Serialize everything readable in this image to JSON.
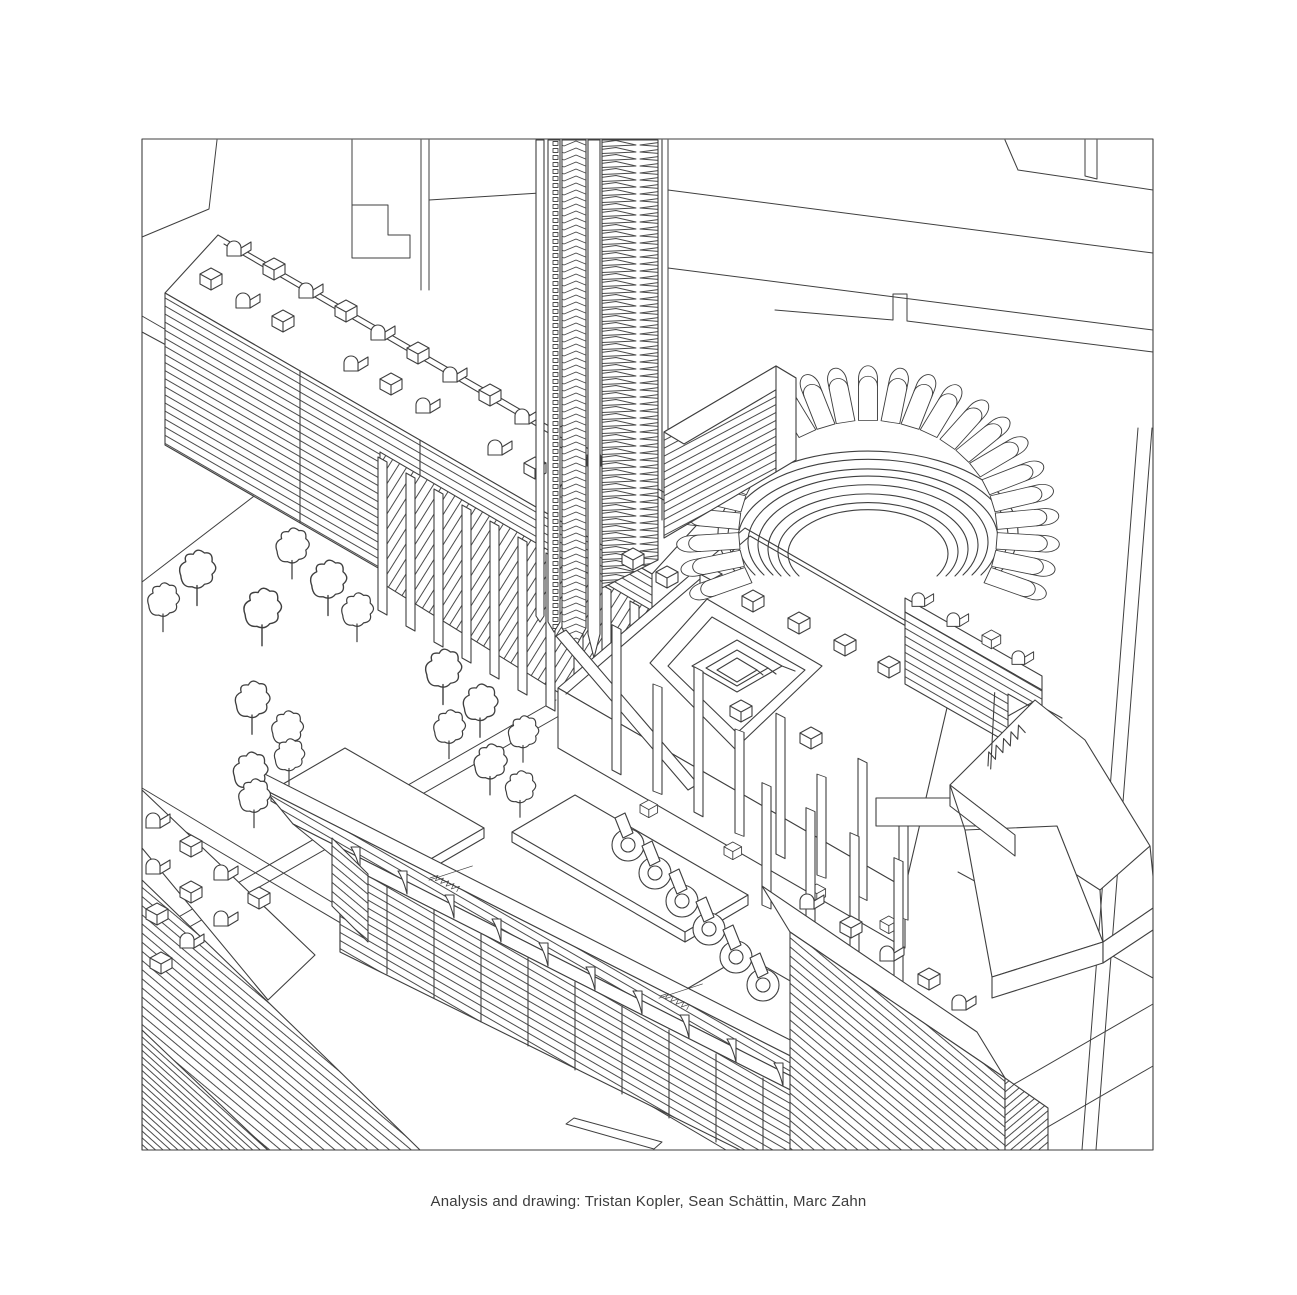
{
  "canvas": {
    "width": 1297,
    "height": 1295,
    "background": "#ffffff"
  },
  "drawing": {
    "title": "Axonometric urban analysis drawing",
    "line_color": "#3f3f3f",
    "paper_color": "#ffffff",
    "frame": {
      "x": 142,
      "y": 139,
      "width": 1011,
      "height": 1011
    },
    "elements": [
      {
        "name": "rooftop-village-slab",
        "desc": "long diagonal slab with barrel-vaulted rooftop houses and striped louver facade"
      },
      {
        "name": "fin-colonnade",
        "desc": "row of tall vertical fins with diagonal lattice below the slab"
      },
      {
        "name": "louver-tower",
        "desc": "tall tower of stacked chevron louvers running to the top edge"
      },
      {
        "name": "horseshoe-arena",
        "desc": "horseshoe building with radial vaulted units and terraced bowl"
      },
      {
        "name": "central-plinth",
        "desc": "raised plinth with sunken square courtyard and spiral pavilion"
      },
      {
        "name": "park",
        "desc": "triangular park with scattered outline trees"
      },
      {
        "name": "perimeter-housing",
        "desc": "terraced housing strip with sail-shaped roof flags"
      },
      {
        "name": "corner-slab",
        "desc": "striped slab with rooftop houses in lower-left corner"
      },
      {
        "name": "southeast-slab",
        "desc": "striped slab with rooftop houses at lower right"
      },
      {
        "name": "tent-podium",
        "desc": "truncated pyramidal podium with sawtooth skylights"
      },
      {
        "name": "hook-pavilions",
        "desc": "row of six hook-shaped pavilions"
      },
      {
        "name": "site-lines",
        "desc": "background parcel boundaries and road lines"
      }
    ]
  },
  "caption": {
    "text": "Analysis and drawing: Tristan Kopler, Sean Schättin, Marc Zahn",
    "color": "#3c3c3c"
  }
}
